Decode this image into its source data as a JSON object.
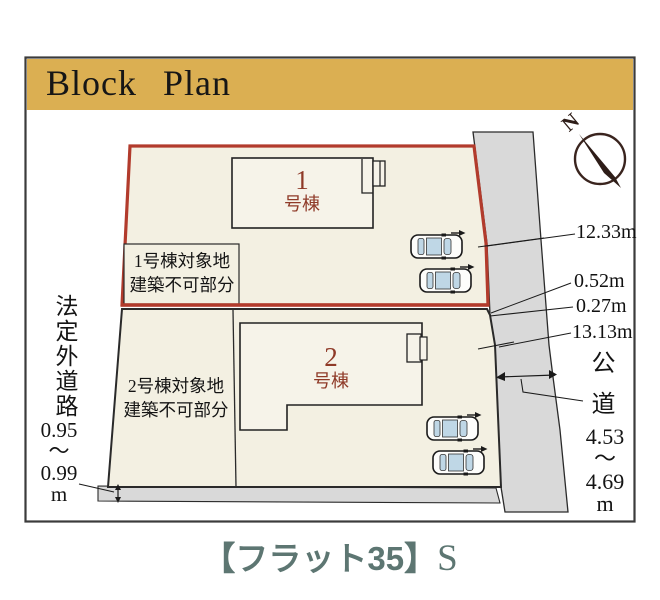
{
  "title": "Block Plan",
  "compass": {
    "north_label": "N"
  },
  "lot1": {
    "building_number": "1",
    "building_suffix": "号棟",
    "restriction_note": "1号棟対象地\n建築不可部分"
  },
  "lot2": {
    "building_number": "2",
    "building_suffix": "号棟",
    "restriction_note": "2号棟対象地\n建築不可部分"
  },
  "boundary_measurements": {
    "seg1": "12.33m",
    "seg2": "0.52m",
    "seg3": "0.27m",
    "seg4": "13.13m"
  },
  "west_road": {
    "name": "法定外道路",
    "width_range": "0.95\n〜\n0.99\nm"
  },
  "east_road": {
    "name": "公道",
    "width_range": "4.53\n〜\n4.69\nm"
  },
  "footer": {
    "loan_label": "【フラット35】",
    "loan_suffix": "S"
  },
  "colors": {
    "banner_gold": "#DBAF52",
    "lot_fill": "#F3F0E2",
    "building_fill": "#F6F3E9",
    "road_gray": "#D9D9D9",
    "lot1_border_red": "#B23B2C",
    "building_label_red": "#8F3A28",
    "footer_teal": "#5D7672",
    "car_glass_blue": "#BFD7E6"
  }
}
